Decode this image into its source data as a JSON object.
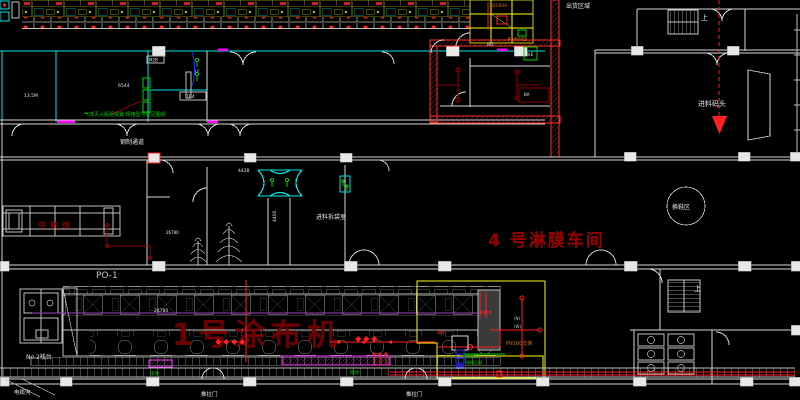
{
  "drawing": {
    "title": "4 号淋膜车间",
    "room_labels": {
      "shipping_area": "出货区域",
      "material_dock": "进料码头",
      "stairs_up_top": "上",
      "stairs_up_bottom": "上",
      "steel_walkway": "钢制通道",
      "debag_room": "进料拆袋室",
      "shoe_change_area": "换鞋区",
      "po1": "PO-1",
      "no2_platform": "No.2栈台",
      "cable_trench": "电缆沟"
    },
    "machine_labels": {
      "coater_name": "1号涂布机",
      "transfer_line": "中转线"
    },
    "doors": {
      "sliding_door_a": "推拉门",
      "sliding_door_b": "推拉门"
    },
    "dimensions": {
      "machine_length": "24780",
      "corridor_width": "4400",
      "bay_width": "4428",
      "left_span": "26780",
      "room_code": "6544",
      "room_area": "13.5M"
    },
    "equipment_codes": {
      "m2b": "M2B",
      "lf": "LF",
      "tb4": "TB4",
      "m2": "M2",
      "ba": "BA",
      "we": "W.E",
      "q1840": "Q1840",
      "pn6465": "PN6465",
      "pn160": "PN160支架",
      "w_supply": "W给水",
      "drain": "排水",
      "tag_n": "(N)",
      "tag_w": "(W)",
      "ground_a": "接地",
      "ground_b": "接地",
      "pump_line1": "给水泵",
      "pump_line2": "规格见图"
    },
    "notes": {
      "gas_extinguisher": "气体灭火瓶组装置 规格型号详见图纸"
    },
    "colors": {
      "background": "#000000",
      "wall_cyan": "#00e5e5",
      "wall_white": "#d9d9d9",
      "accent_red": "#ff2020",
      "dark_red": "#8f0000",
      "title_red": "#9a0000",
      "magenta": "#ff00ff",
      "centerline_violet": "#a040c0",
      "yellow": "#ffff00",
      "green": "#00d000",
      "blue": "#2030ff",
      "orange": "#c8702a"
    }
  }
}
